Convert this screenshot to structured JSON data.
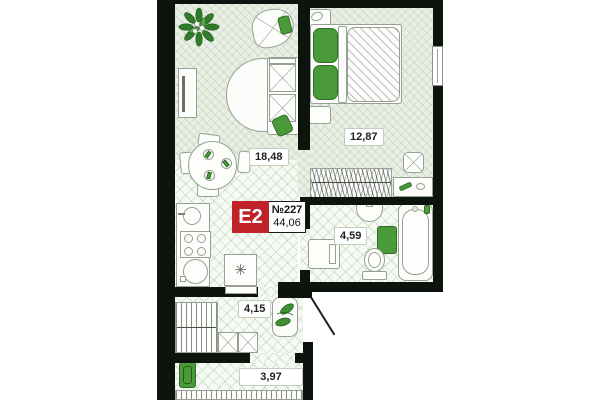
{
  "unit": {
    "code": "E2",
    "number_label": "№227",
    "area_label": "44,06"
  },
  "rooms": [
    {
      "id": "living-kitchen",
      "area_label": "18,48"
    },
    {
      "id": "bedroom",
      "area_label": "12,87"
    },
    {
      "id": "bathroom",
      "area_label": "4,59"
    },
    {
      "id": "hallway",
      "area_label": "4,15"
    },
    {
      "id": "corridor",
      "area_label": "3,97"
    }
  ],
  "glyphs": {
    "fridge": "✳"
  },
  "colors": {
    "wall": "#0c140d",
    "accent_red": "#bf2228",
    "accent_green": "#4a9a3a",
    "green_dark": "#2c6e24",
    "line": "#96a094",
    "floor_wood": "#e9efe4",
    "floor_tile": "#f7faf4",
    "ink": "#222222"
  }
}
